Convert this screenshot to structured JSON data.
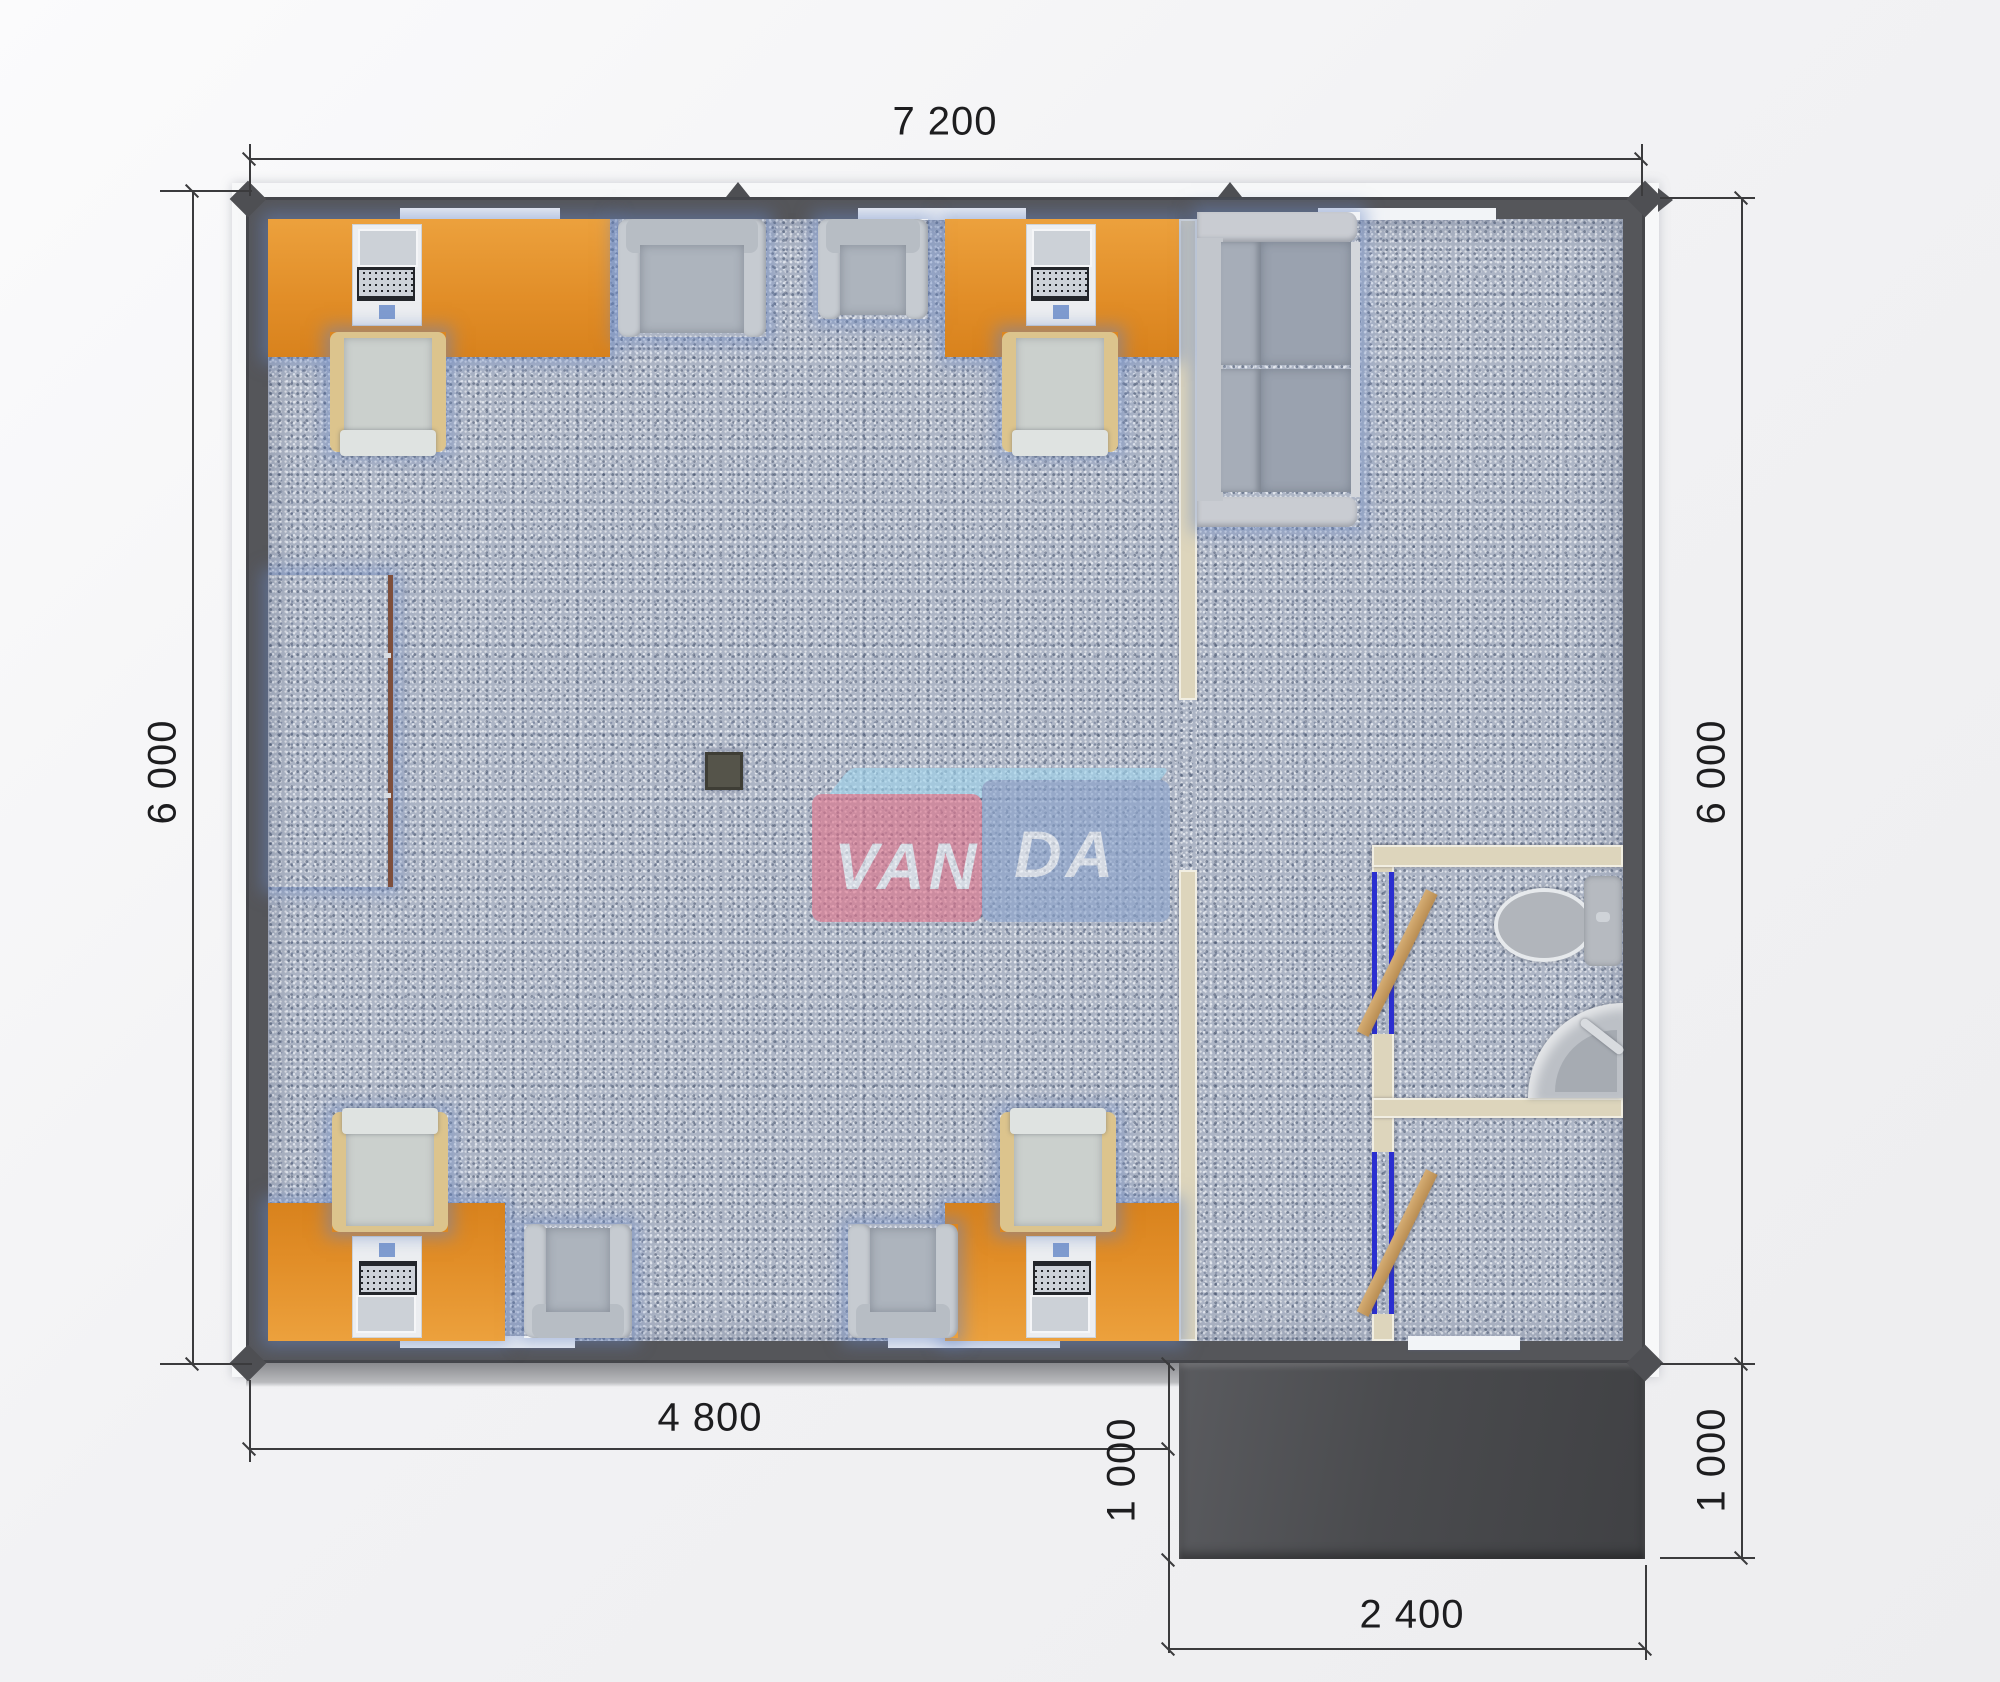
{
  "title": "VANDA modular office floor plan render",
  "dimensions": {
    "top_width": "7 200",
    "left_height": "6 000",
    "right_height": "6 000",
    "office_width": "4 800",
    "porch_depth_left": "1 000",
    "porch_depth_right": "1 000",
    "porch_width": "2 400"
  },
  "watermark": {
    "part1": "VAN",
    "part2": "DA"
  },
  "colors": {
    "wall": "#55565a",
    "carpet": "#adb5c5",
    "desk_orange": "#e18d27",
    "partition_beige": "#ddd5bc",
    "door_frame_blue": "#2b2fd0",
    "door_leaf_tan": "#c9a express",
    "sideboard_brown": "#b5765b",
    "porch_dark": "#4a4b4e",
    "watermark_pink": "#e0738b",
    "watermark_blue": "#8aa3cc"
  },
  "rooms": {
    "office": "open office with 4 desks, 4 task chairs, 4 armchairs, sideboard, floor drain",
    "lounge": "lounge with two-seat sofa",
    "wc": "WC with toilet and corner sink",
    "vestibule": "entrance vestibule with exterior door to porch"
  }
}
